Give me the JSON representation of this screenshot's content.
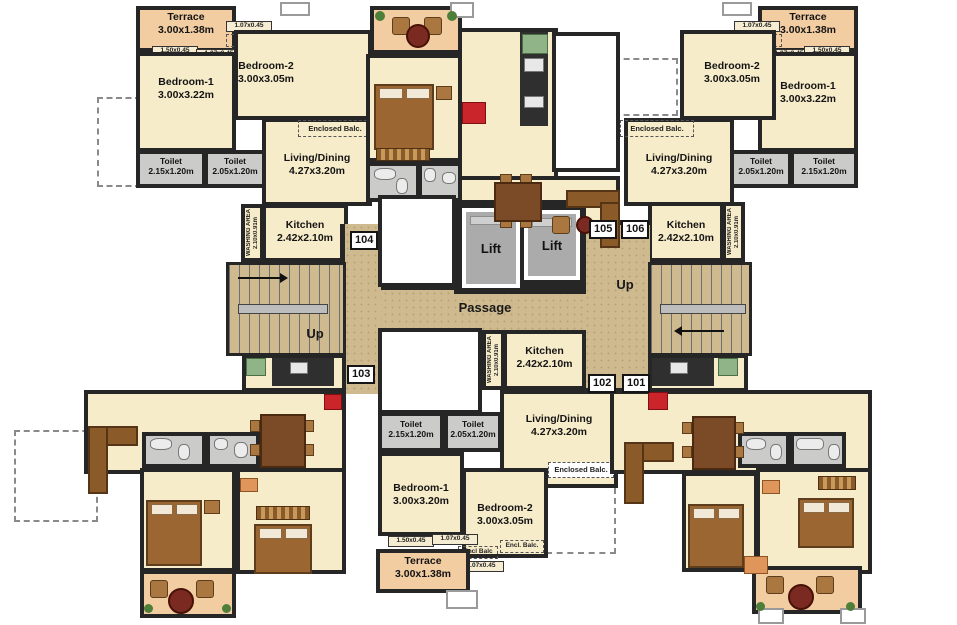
{
  "colors": {
    "wall": "#262626",
    "room_cream": "#f7ecca",
    "terrace_peach": "#f2cda2",
    "toilet_gray": "#cbcbc9",
    "corridor_tan": "#cfba8f",
    "accent_red": "#c9252b",
    "sink_green": "#90b487",
    "lift_cab": "#ababab"
  },
  "core": {
    "lift_left": "Lift",
    "lift_right": "Lift",
    "passage": "Passage",
    "up_left": "Up",
    "up_right": "Up",
    "tags": {
      "t101": "101",
      "t102": "102",
      "t103": "103",
      "t104": "104",
      "t105": "105",
      "t106": "106"
    }
  },
  "units": {
    "top_left": {
      "terrace": {
        "name": "Terrace",
        "dims": "3.00x1.38m"
      },
      "bedroom1": {
        "name": "Bedroom-1",
        "dims": "3.00x3.22m"
      },
      "bedroom2": {
        "name": "Bedroom-2",
        "dims": "3.00x3.05m"
      },
      "living": {
        "name": "Living/Dining",
        "dims": "4.27x3.20m"
      },
      "kitchen": {
        "name": "Kitchen",
        "dims": "2.42x2.10m"
      },
      "toilet1": {
        "name": "Toilet",
        "dims": "2.15x1.20m"
      },
      "toilet2": {
        "name": "Toilet",
        "dims": "2.05x1.20m"
      },
      "washing": {
        "name": "WASHING AREA",
        "dims": "2.10x0.91m"
      },
      "encl_tiny": "Encl. Balc.",
      "encl_small": "Encl. Balc.",
      "enclosed_balc": "Enclosed Balc.",
      "dim_a": "1.07x0.45",
      "dim_b": "1.07x0.45",
      "dim_c": "1.50x0.45"
    },
    "top_right": {
      "terrace": {
        "name": "Terrace",
        "dims": "3.00x1.38m"
      },
      "bedroom1": {
        "name": "Bedroom-1",
        "dims": "3.00x3.22m"
      },
      "bedroom2": {
        "name": "Bedroom-2",
        "dims": "3.00x3.05m"
      },
      "living": {
        "name": "Living/Dining",
        "dims": "4.27x3.20m"
      },
      "kitchen": {
        "name": "Kitchen",
        "dims": "2.42x2.10m"
      },
      "toilet1": {
        "name": "Toilet",
        "dims": "2.05x1.20m"
      },
      "toilet2": {
        "name": "Toilet",
        "dims": "2.15x1.20m"
      },
      "washing": {
        "name": "WASHING AREA",
        "dims": "2.10x0.91m"
      },
      "encl_tiny": "Encl. Balc.",
      "encl_small": "Encl. Balc.",
      "enclosed_balc": "Enclosed Balc.",
      "dim_a": "1.07x0.45",
      "dim_b": "1.07x0.45",
      "dim_c": "1.50x0.45"
    },
    "bottom_center": {
      "terrace": {
        "name": "Terrace",
        "dims": "3.00x1.38m"
      },
      "bedroom1": {
        "name": "Bedroom-1",
        "dims": "3.00x3.20m"
      },
      "bedroom2": {
        "name": "Bedroom-2",
        "dims": "3.00x3.05m"
      },
      "living": {
        "name": "Living/Dining",
        "dims": "4.27x3.20m"
      },
      "kitchen": {
        "name": "Kitchen",
        "dims": "2.42x2.10m"
      },
      "toilet1": {
        "name": "Toilet",
        "dims": "2.15x1.20m"
      },
      "toilet2": {
        "name": "Toilet",
        "dims": "2.05x1.20m"
      },
      "washing": {
        "name": "WASHING AREA",
        "dims": "2.10x0.91m"
      },
      "encl_small_a": "Encl Balc",
      "encl_small_b": "Encl. Balc.",
      "enclosed_balc": "Enclosed Balc.",
      "dim_a": "1.07x0.45",
      "dim_b": "1.07x0.45",
      "dim_c": "1.50x0.45"
    }
  }
}
